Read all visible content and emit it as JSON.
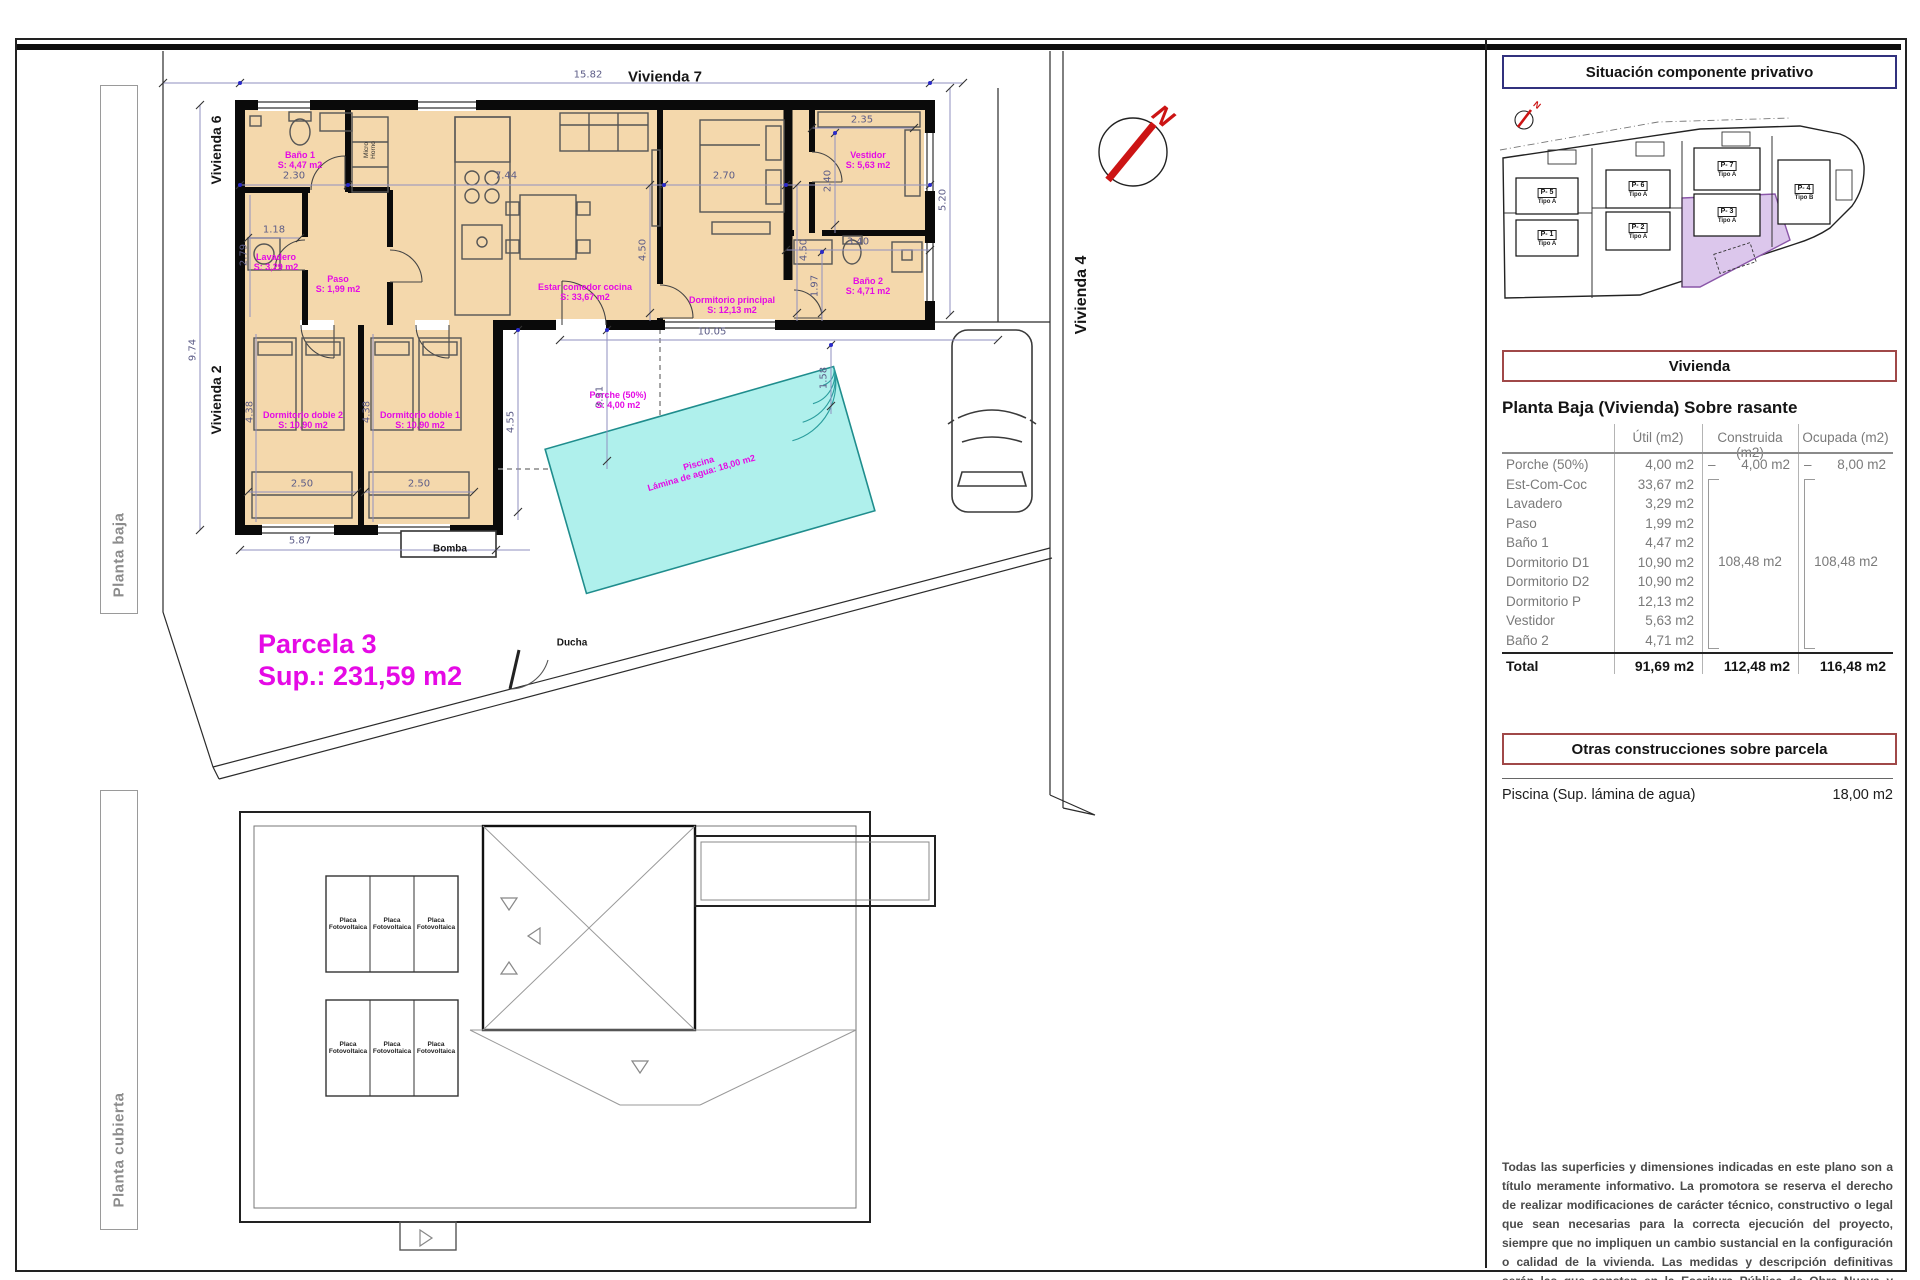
{
  "sheet": {
    "tabs": {
      "planta_baja": "Planta baja",
      "planta_cubierta": "Planta cubierta"
    }
  },
  "floor_plan": {
    "neighbors": {
      "top": "Vivienda 7",
      "left_top": "Vivienda 6",
      "left_bottom": "Vivienda 2",
      "right": "Vivienda 4"
    },
    "rooms": [
      {
        "name": "Baño 1",
        "area": "S: 4,47 m2"
      },
      {
        "name": "Lavadero",
        "area": "S: 3,29 m2"
      },
      {
        "name": "Paso",
        "area": "S: 1,99 m2"
      },
      {
        "name": "Estar comedor cocina",
        "area": "S: 33,67 m2"
      },
      {
        "name": "Dormitorio principal",
        "area": "S: 12,13 m2"
      },
      {
        "name": "Vestidor",
        "area": "S: 5,63 m2"
      },
      {
        "name": "Baño 2",
        "area": "S: 4,71 m2"
      },
      {
        "name": "Dormitorio doble 2",
        "area": "S: 10,90 m2"
      },
      {
        "name": "Dormitorio doble 1",
        "area": "S: 10,90 m2"
      },
      {
        "name": "Porche (50%)",
        "area": "S: 4,00 m2"
      }
    ],
    "pool": {
      "name": "Piscina",
      "area": "Lámina de agua: 18,00 m2"
    },
    "parcel": {
      "name": "Parcela 3",
      "area": "Sup.: 231,59 m2"
    },
    "annotations": {
      "bomba": "Bomba",
      "ducha": "Ducha",
      "micro": "Micro",
      "horno": "Horno",
      "north": "N"
    },
    "dims": {
      "d1582": "15.82",
      "d974": "9.74",
      "d230": "2.30",
      "d118": "1.18",
      "d279": "2.79",
      "d744": "7.44",
      "d270": "2.70",
      "d450a": "4.50",
      "d450b": "4.50",
      "d235": "2.35",
      "d240": "2.40",
      "d340": "3.40",
      "d197": "1.97",
      "d520": "5.20",
      "d1005": "10.05",
      "d158": "1.58",
      "d455": "4.55",
      "d331": "3.31",
      "d250a": "2.50",
      "d250b": "2.50",
      "d587": "5.87",
      "d438a": "4.38",
      "d438b": "4.38"
    }
  },
  "roof_plan": {
    "placa_l1": "Placa",
    "placa_l2": "Fotovoltaica"
  },
  "site_plan": {
    "title": "Situación componente privativo",
    "north": "N",
    "parcels": [
      {
        "id": "P- 5",
        "tipo": "Tipo A"
      },
      {
        "id": "P- 1",
        "tipo": "Tipo A"
      },
      {
        "id": "P- 6",
        "tipo": "Tipo A"
      },
      {
        "id": "P- 2",
        "tipo": "Tipo A"
      },
      {
        "id": "P- 7",
        "tipo": "Tipo A"
      },
      {
        "id": "P- 3",
        "tipo": "Tipo A"
      },
      {
        "id": "P- 4",
        "tipo": "Tipo B"
      }
    ]
  },
  "panel": {
    "vivienda_title": "Vivienda",
    "planta_baja_heading": "Planta Baja (Vivienda) Sobre rasante",
    "table": {
      "col_util": "Útil (m2)",
      "col_construida": "Construida (m2)",
      "col_ocupada": "Ocupada (m2)",
      "rows": [
        {
          "name": "Porche (50%)",
          "util": "4,00 m2"
        },
        {
          "name": "Est-Com-Coc",
          "util": "33,67 m2"
        },
        {
          "name": "Lavadero",
          "util": "3,29 m2"
        },
        {
          "name": "Paso",
          "util": "1,99 m2"
        },
        {
          "name": "Baño 1",
          "util": "4,47 m2"
        },
        {
          "name": "Dormitorio D1",
          "util": "10,90 m2"
        },
        {
          "name": "Dormitorio D2",
          "util": "10,90 m2"
        },
        {
          "name": "Dormitorio P",
          "util": "12,13 m2"
        },
        {
          "name": "Vestidor",
          "util": "5,63 m2"
        },
        {
          "name": "Baño 2",
          "util": "4,71 m2"
        }
      ],
      "porche_construida_dash": "–",
      "porche_construida": "4,00 m2",
      "porche_ocupada_dash": "–",
      "porche_ocupada": "8,00 m2",
      "construida_group": "108,48 m2",
      "ocupada_group": "108,48 m2",
      "total_label": "Total",
      "total_util": "91,69 m2",
      "total_construida": "112,48 m2",
      "total_ocupada": "116,48 m2"
    },
    "otras_title": "Otras construcciones sobre parcela",
    "piscina_label": "Piscina (Sup. lámina de agua)",
    "piscina_value": "18,00 m2",
    "disclaimer": "Todas las superficies y dimensiones indicadas en este plano son a título meramente informativo. La promotora se reserva el derecho de realizar modificaciones de carácter técnico, constructivo o legal que sean necesarias para la correcta ejecución del proyecto, siempre que no impliquen un cambio sustancial en la configuración o calidad de la vivienda. Las medidas y descripción definitivas serán las que consten en la Escritura Pública de Obra Nueva y División Horizontal. Los elementos de mobiliario y decoración son ilustrativos y no están incluidos."
  }
}
